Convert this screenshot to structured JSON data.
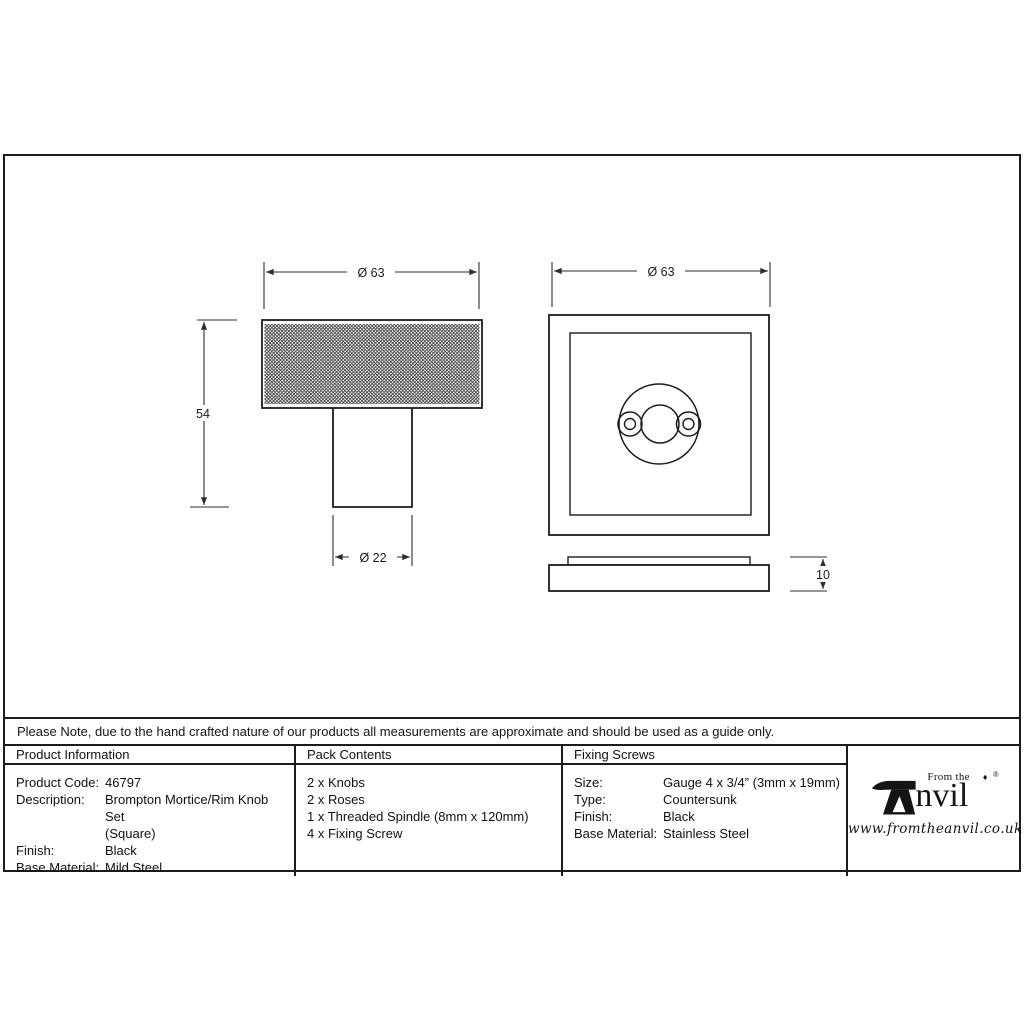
{
  "drawing": {
    "knob_view": {
      "name": "knurled knob side view",
      "width_dim": "Ø 63",
      "height_dim": "54",
      "stem_dim": "Ø 22"
    },
    "rose_view": {
      "name": "square rose front and profile view",
      "width_dim": "Ø 63",
      "thickness_dim": "10"
    }
  },
  "note": "Please Note, due to the hand crafted nature of our products all measurements are approximate and should be used as a guide only.",
  "table": {
    "product_information": {
      "header": "Product Information",
      "product_code_label": "Product Code:",
      "product_code": "46797",
      "description_label": "Description:",
      "description_line1": "Brompton Mortice/Rim Knob Set",
      "description_line2": "(Square)",
      "finish_label": "Finish:",
      "finish": "Black",
      "base_material_label": "Base Material:",
      "base_material": "Mild Steel"
    },
    "pack_contents": {
      "header": "Pack Contents",
      "item1": "2 x Knobs",
      "item2": "2 x Roses",
      "item3": "1 x Threaded Spindle (8mm x 120mm)",
      "item4": "4 x Fixing Screw"
    },
    "fixing_screws": {
      "header": "Fixing Screws",
      "size_label": "Size:",
      "size": "Gauge 4 x 3/4” (3mm x 19mm)",
      "type_label": "Type:",
      "type": "Countersunk",
      "finish_label": "Finish:",
      "finish": "Black",
      "base_material_label": "Base Material:",
      "base_material": "Stainless Steel"
    }
  },
  "logo": {
    "from_the": "From the",
    "diamond": "♦",
    "name_rest": "nvil",
    "registered": "®",
    "website": "www.fromtheanvil.co.uk"
  },
  "colors": {
    "line": "#1c1c1c",
    "dim_line": "#2e2e2e",
    "background": "#ffffff"
  }
}
